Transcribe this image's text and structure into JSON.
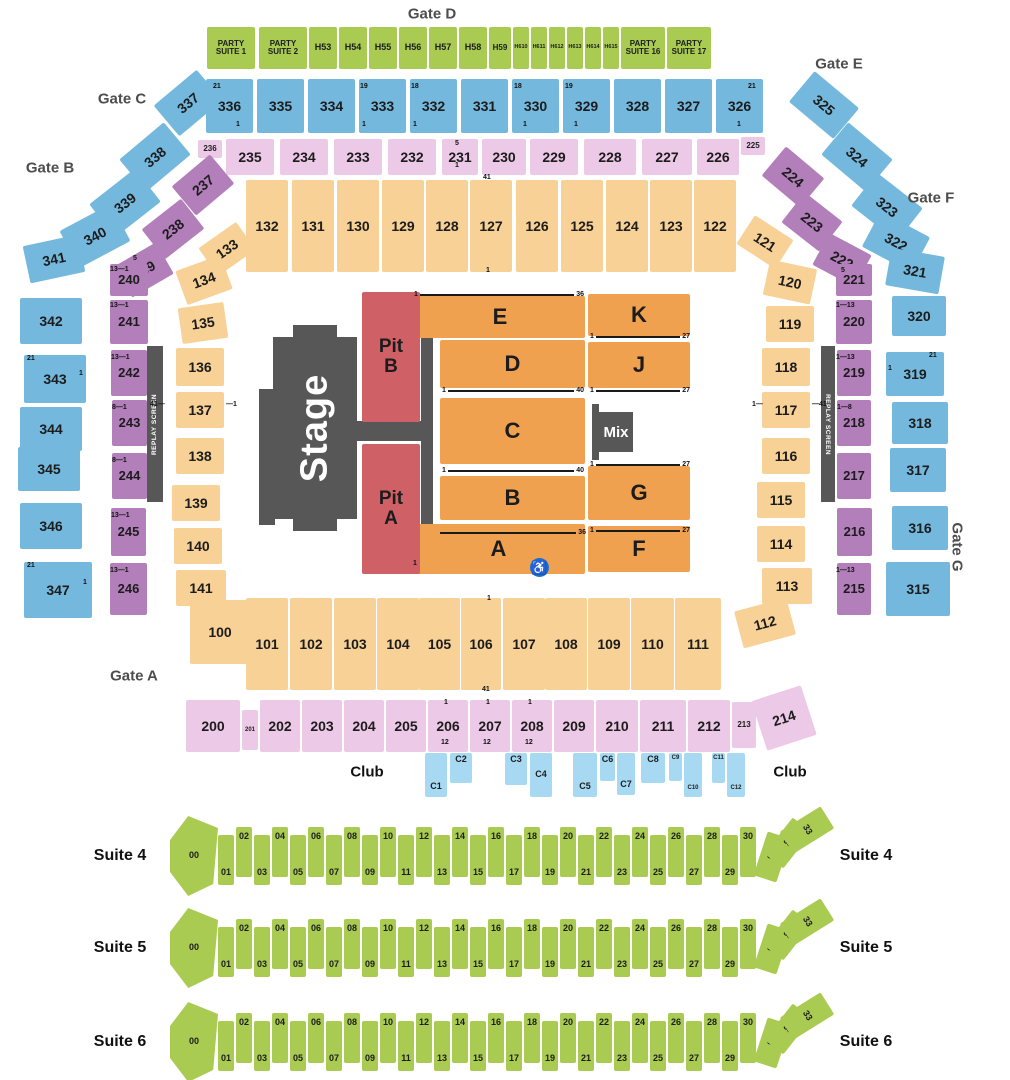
{
  "gates": [
    "Gate D",
    "Gate C",
    "Gate B",
    "Gate E",
    "Gate F",
    "Gate G",
    "Gate A"
  ],
  "party_suites": [
    "PARTY SUITE 1",
    "PARTY SUITE 2",
    "H53",
    "H54",
    "H55",
    "H56",
    "H57",
    "H58",
    "H59",
    "H610",
    "H611",
    "H612",
    "H613",
    "H614",
    "H615",
    "PARTY SUITE 16",
    "PARTY SUITE 17"
  ],
  "sections": {
    "level300_top": [
      "336",
      "335",
      "334",
      "333",
      "332",
      "331",
      "330",
      "329",
      "328",
      "327",
      "326"
    ],
    "level300_left": [
      "337",
      "338",
      "339",
      "340",
      "341",
      "342",
      "343",
      "344",
      "345",
      "346",
      "347"
    ],
    "level300_right": [
      "325",
      "324",
      "323",
      "322",
      "321",
      "320",
      "319",
      "318",
      "317",
      "316",
      "315"
    ],
    "level200_top": [
      "236",
      "235",
      "234",
      "233",
      "232",
      "231",
      "230",
      "229",
      "228",
      "227",
      "226",
      "225"
    ],
    "level200_left": [
      "237",
      "238",
      "239",
      "240",
      "241",
      "242",
      "243",
      "244",
      "245",
      "246"
    ],
    "level200_right": [
      "224",
      "223",
      "222",
      "221",
      "220",
      "219",
      "218",
      "217",
      "216",
      "215"
    ],
    "level100_top": [
      "132",
      "131",
      "130",
      "129",
      "128",
      "127",
      "126",
      "125",
      "124",
      "123",
      "122"
    ],
    "level100_left": [
      "133",
      "134",
      "135",
      "136",
      "137",
      "138",
      "139",
      "140",
      "141"
    ],
    "level100_right": [
      "121",
      "120",
      "119",
      "118",
      "117",
      "116",
      "115",
      "114",
      "113",
      "112"
    ],
    "level100_bottom": [
      "100",
      "101",
      "102",
      "103",
      "104",
      "105",
      "106",
      "107",
      "108",
      "109",
      "110",
      "111"
    ],
    "level200_bottom": [
      "200",
      "201",
      "202",
      "203",
      "204",
      "205",
      "206",
      "207",
      "208",
      "209",
      "210",
      "211",
      "212",
      "213",
      "214"
    ],
    "floor": [
      "E",
      "D",
      "C",
      "B",
      "A",
      "K",
      "J",
      "G",
      "F"
    ],
    "pits": [
      "Pit B",
      "Pit A"
    ],
    "club": [
      "C1",
      "C2",
      "C3",
      "C4",
      "C5",
      "C6",
      "C7",
      "C8",
      "C9",
      "C10",
      "C11",
      "C12"
    ]
  },
  "floor_row_marks": [
    {
      "left": "1",
      "right": "36"
    },
    {
      "left": "1",
      "right": "40"
    },
    {
      "left": "1",
      "right": "40"
    },
    {
      "left": "",
      "right": "36"
    },
    {
      "left": "1",
      "right": "27"
    },
    {
      "left": "1",
      "right": "27"
    },
    {
      "left": "1",
      "right": "27"
    },
    {
      "left": "1",
      "right": "27"
    }
  ],
  "marks": [
    "21",
    "1",
    "19",
    "1",
    "18",
    "1",
    "18",
    "1",
    "19",
    "1",
    "21",
    "1",
    "5",
    "1",
    "41",
    "1",
    "1",
    "41",
    "21",
    "1",
    "21",
    "1",
    "21",
    "1",
    "5",
    "13—1",
    "13—1",
    "13—1",
    "8—1",
    "8—1",
    "13—1",
    "13—1",
    "5",
    "1—13",
    "1—13",
    "1—8",
    "1—13",
    "41—",
    "—1",
    "1—",
    "—41",
    "1",
    "12",
    "1",
    "12",
    "1",
    "12",
    "1"
  ],
  "stage_label": "Stage",
  "mix_label": "Mix",
  "replay_label": "REPLAY SCREEN",
  "club_label": "Club",
  "accessible_icon": "♿",
  "suites": {
    "labels": [
      "Suite 4",
      "Suite 5",
      "Suite 6"
    ],
    "boxes": [
      "00",
      "01",
      "02",
      "03",
      "04",
      "05",
      "06",
      "07",
      "08",
      "09",
      "10",
      "11",
      "12",
      "13",
      "14",
      "15",
      "16",
      "17",
      "18",
      "19",
      "20",
      "21",
      "22",
      "23",
      "24",
      "25",
      "26",
      "27",
      "28",
      "29",
      "30",
      "31",
      "32",
      "33"
    ]
  },
  "colors": {
    "green": "#a9cb52",
    "blue": "#74b9dd",
    "pink": "#ecc9e6",
    "purple": "#b37fbb",
    "tan": "#f7d196",
    "orange": "#f0a150",
    "red": "#cf6066",
    "dark": "#575757",
    "club_blue": "#a8d9f2",
    "accessible_blue": "#1b6ed0",
    "gate_text": "#4d4d4d"
  }
}
